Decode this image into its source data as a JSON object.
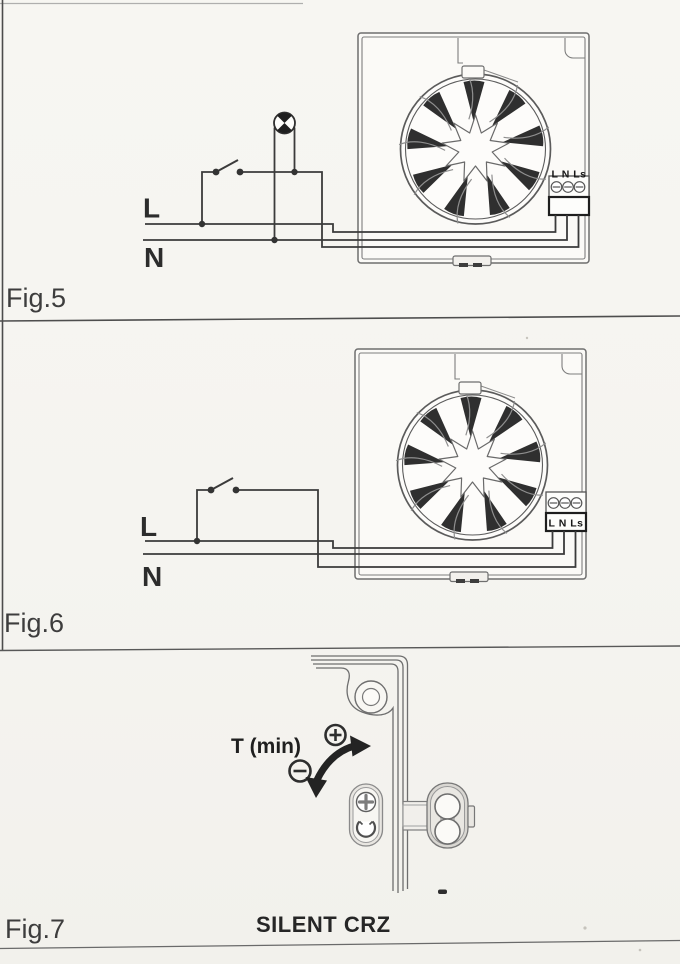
{
  "page": {
    "background": "#f6f5f1",
    "ink_color": "#3b3b3b",
    "housing_line_color": "#6e6e6e"
  },
  "fig5": {
    "caption": "Fig.5",
    "live_label": "L",
    "neutral_label": "N",
    "terminal_label": "L N Ls",
    "icons": {
      "lamp": "lamp-indicator",
      "switch": "single-pole-switch",
      "fan": "extractor-fan-unit"
    }
  },
  "fig6": {
    "caption": "Fig.6",
    "live_label": "L",
    "neutral_label": "N",
    "terminal_label": "L N Ls",
    "icons": {
      "switch": "single-pole-switch",
      "fan": "extractor-fan-unit"
    }
  },
  "fig7": {
    "caption": "Fig.7",
    "timer_label": "T (min)",
    "product_label": "SILENT CRZ",
    "icons": {
      "plus": "plus-in-circle",
      "minus": "minus-in-circle",
      "arrow": "rotate-adjustment-arrow",
      "screw": "phillips-screw",
      "trimmer": "timer-trimmer"
    }
  }
}
